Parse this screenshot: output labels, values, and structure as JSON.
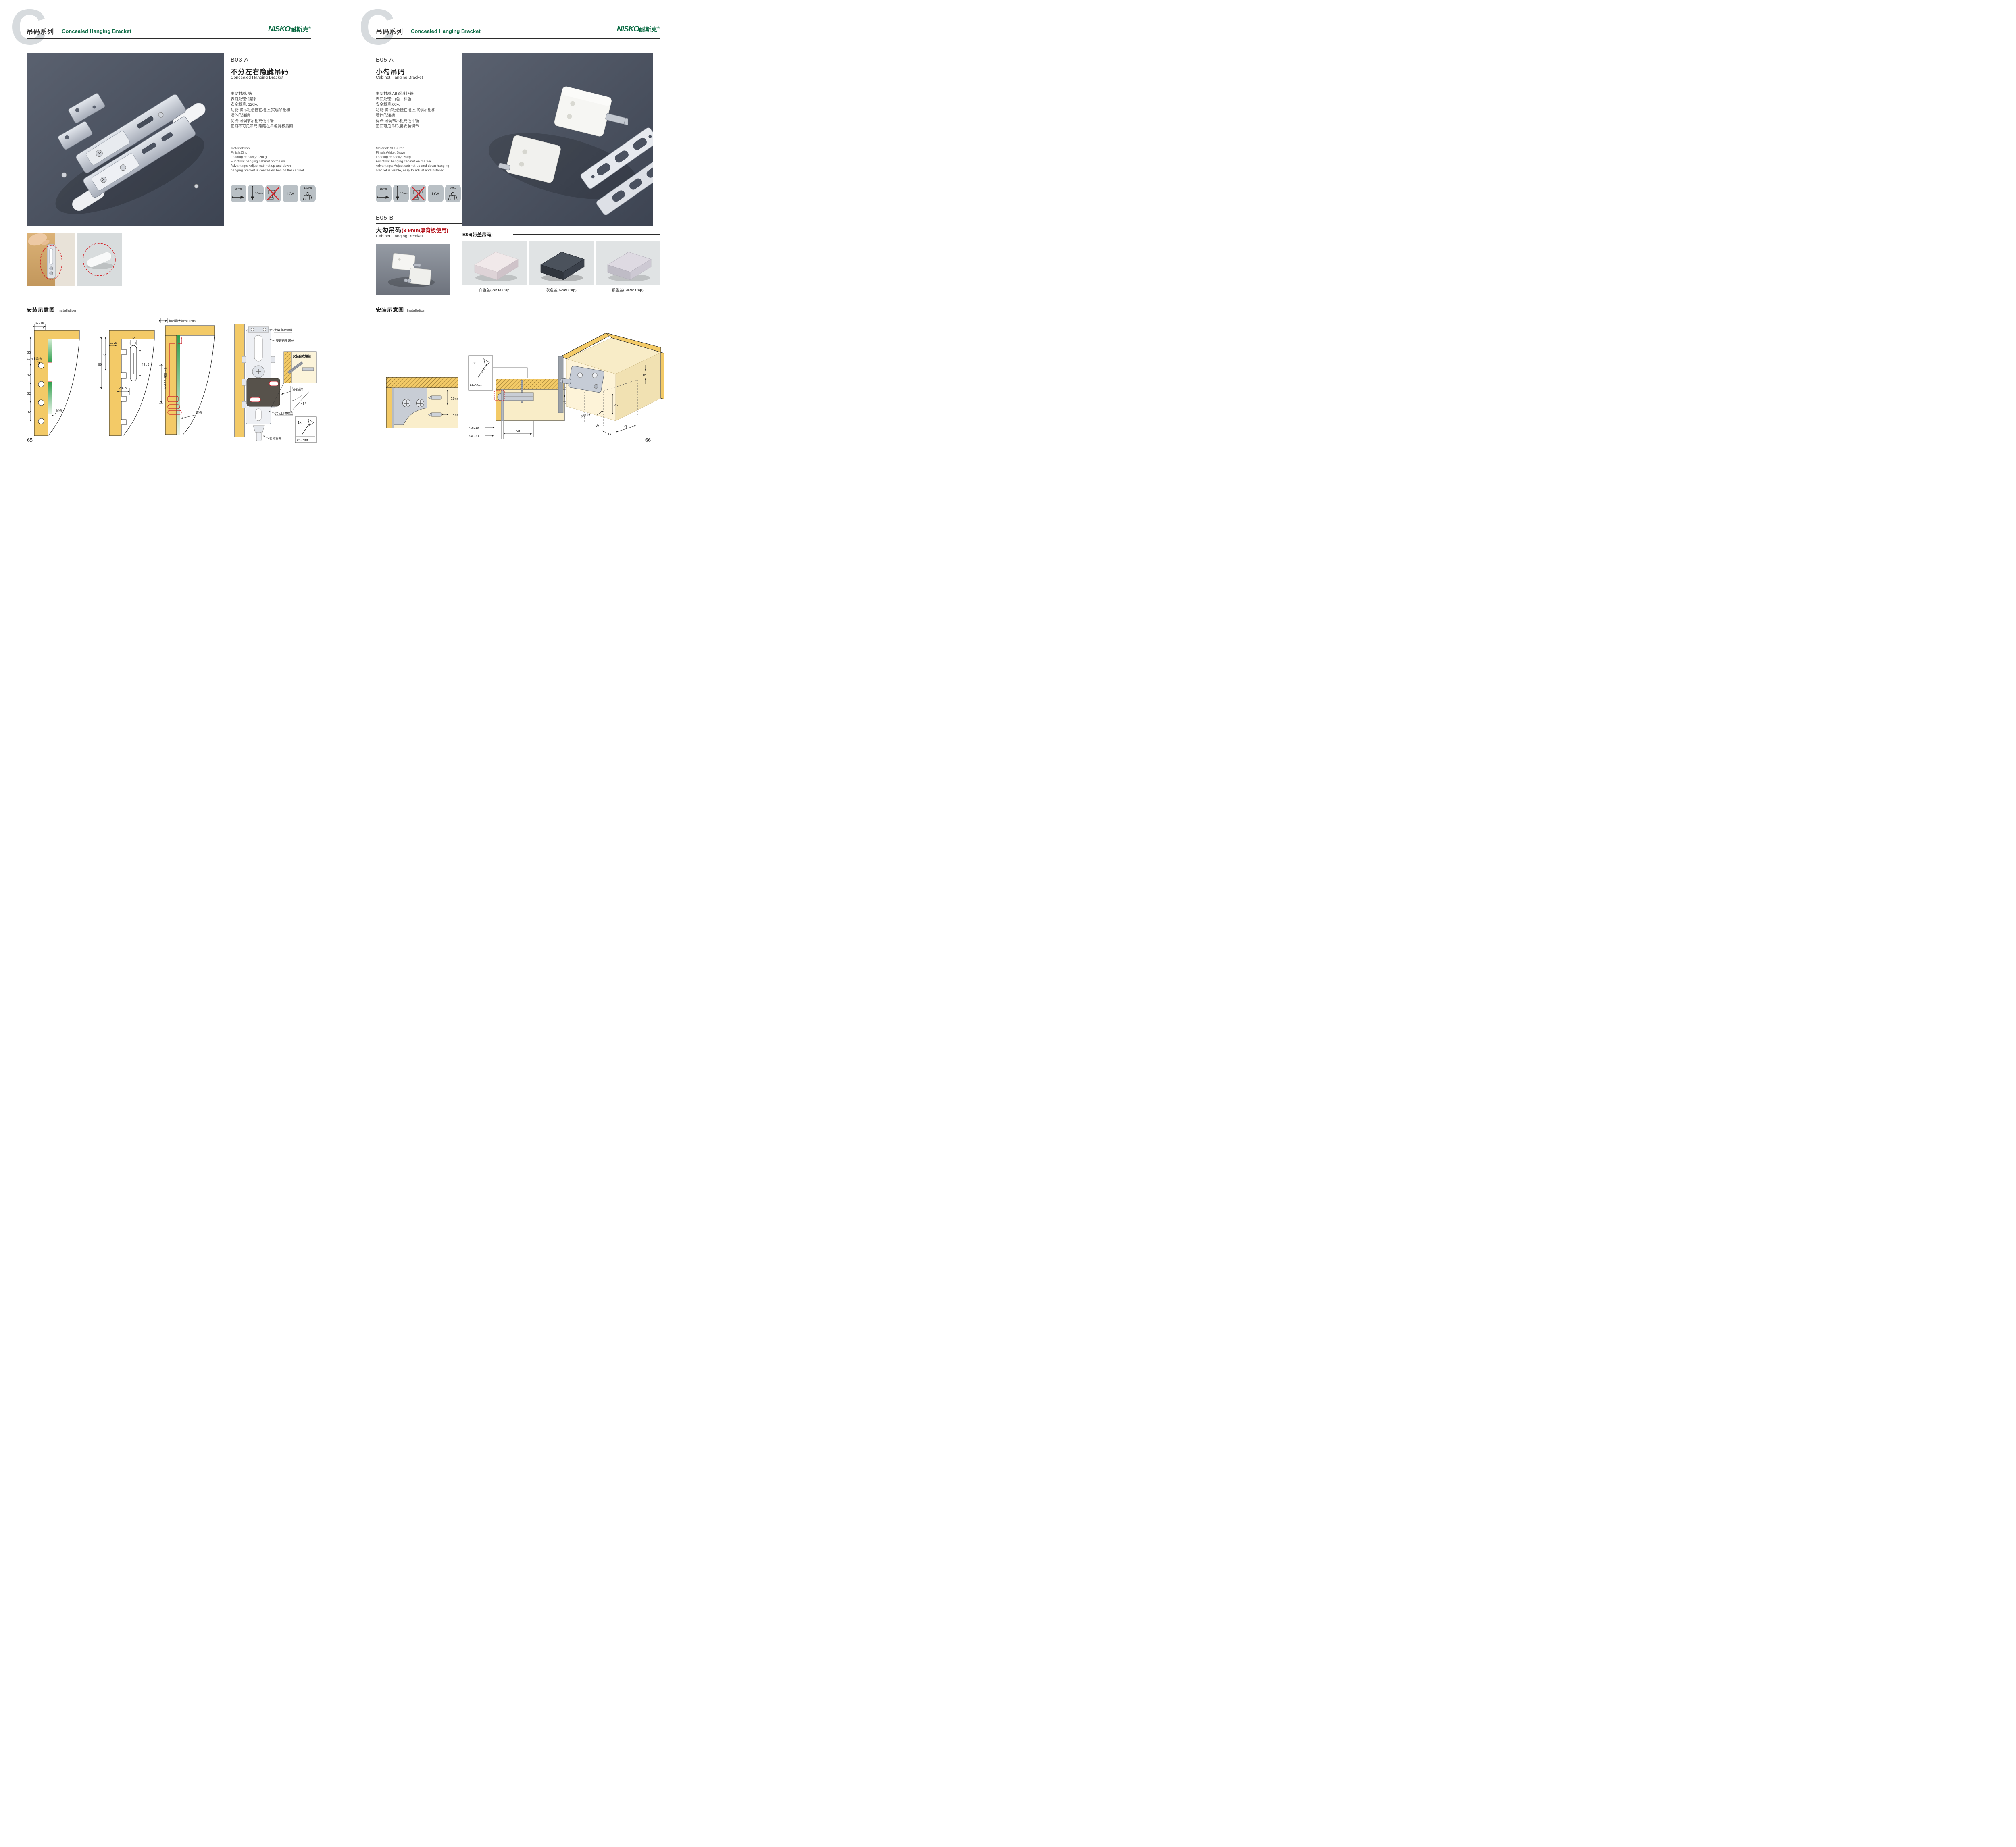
{
  "header": {
    "series_zh": "吊码系列",
    "series_en": "Concealed Hanging Bracket",
    "logo_latin": "NISKO",
    "logo_zh": "耐斯克",
    "logo_reg": "®",
    "watermark_letter": "C"
  },
  "left_page": {
    "page_number": "65",
    "product": {
      "code": "B03-A",
      "name_zh": "不分左右隐藏吊码",
      "name_en": "Concealed Hanging Bracket",
      "specs_zh": [
        "主要材质: 铁",
        "表面处理: 镀锌",
        "安全载重: 120kg",
        "功能:将吊柜悬挂在墙上,实现吊柜和",
        "墙体的连接",
        "优点:可调节吊柜高低平衡",
        "正面不可见吊码,隐藏在吊柜背板后面"
      ],
      "specs_en": [
        "Material:Iron",
        "Finish:Zinc",
        "Loading capacity:120kg",
        "Function: hanging cabinet on the wall",
        "Advantage: Adjust cabinet up and down",
        "hanging bracket is concealed behind the cabinet"
      ],
      "icons": [
        "10mm",
        "10mm",
        "no-drill",
        "LGA",
        "120Kg"
      ]
    },
    "installation": {
      "title_zh": "安装示意图",
      "title_en": "Installation",
      "d1": {
        "dim_wall": "16-18",
        "dim_inset": "5",
        "dim_top": "35",
        "dim_a": "32",
        "dim_b": "32",
        "dim_c": "32",
        "note_holes": "10-4个均布",
        "note_backboard": "背板"
      },
      "d2": {
        "dim_outer": "60",
        "dim_inner": "35",
        "dim_offset": "12.5",
        "dim_slot_w": "12",
        "dim_slot_h": "42.5",
        "dim_slot_x": "20.5"
      },
      "d3": {
        "note_top": "前后最大调节10mm",
        "note_side": "上下调节10mm",
        "note_backboard": "背板"
      },
      "d4": {
        "note_screw_1": "安装自攻螺丝",
        "note_screw_2": "安装自攻螺丝",
        "note_screw_3": "安装自攻螺丝",
        "note_plate": "专用挂片",
        "note_lock": "锁紧状态"
      },
      "detail": {
        "note_screw": "安装自攻螺丝",
        "angle": "45°",
        "qty": "1x",
        "diameter": "Φ3.5mm"
      }
    }
  },
  "right_page": {
    "page_number": "66",
    "product_a": {
      "code": "B05-A",
      "name_zh": "小勾吊码",
      "name_en": "Cabinet Hanging Bracket",
      "specs_zh": [
        "主要材质:ABS塑料+铁",
        "表面处理:白色、棕色",
        "安全载重:60kg",
        "功能:将吊柜悬挂在墙上,实现吊柜和",
        "墙体的连接",
        "优点:可调节吊柜高低平衡",
        "正面可见吊码,易安装调节"
      ],
      "specs_en": [
        "Material: ABS+Iron",
        "Finish:White, Brown",
        "Loading capacity: 60kg",
        "Function: hanging cabinet on the wall",
        "Advantage: Adjust cabinet up and down hanging",
        "bracket is visible, easy to adjust and installed"
      ],
      "icons": [
        "15mm",
        "10mm",
        "no-drill",
        "LGA",
        "60Kg"
      ]
    },
    "product_b": {
      "code": "B05-B",
      "name_zh": "大勾吊码",
      "name_note": "(3-9mm厚背板使用)",
      "name_en": "Cabinet Hanging Brcaket"
    },
    "product_b06": {
      "title": "B06(带盖吊码)",
      "cap_labels": [
        "白色盖(White Cap)",
        "灰色盖(Gray Cap)",
        "银色盖(Silver Cap)"
      ]
    },
    "installation": {
      "title_zh": "安装示意图",
      "title_en": "Installation",
      "d1": {
        "dim_v": "10mm",
        "dim_h": "15mm"
      },
      "d2": {
        "qty": "2x",
        "diameter": "Φ4×30mm",
        "dim_depth": "18",
        "dim_min": "MIN.10",
        "dim_max": "MAX.23",
        "dim_span": "58"
      },
      "d3": {
        "dim_16_top": "16",
        "dim_42": "42",
        "dim_rmax": "RMAX4",
        "dim_16_bottom": "16",
        "dim_17": "17",
        "dim_32": "32"
      }
    }
  }
}
